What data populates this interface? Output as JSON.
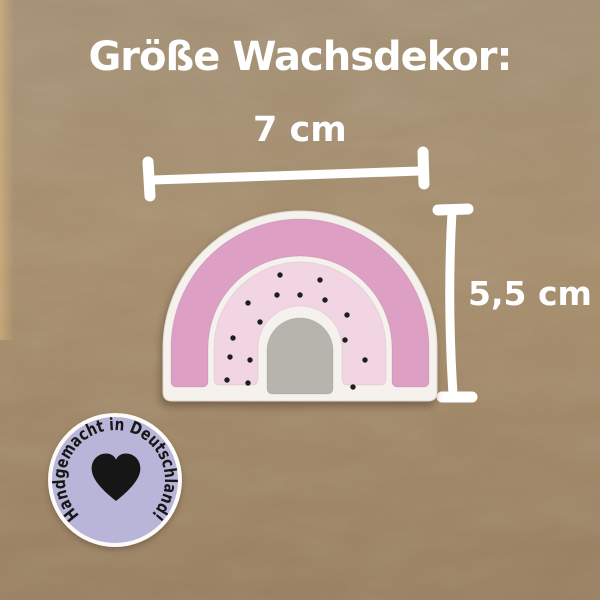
{
  "page": {
    "title": "Größe Wachsdekor:"
  },
  "measurements": {
    "width_label": "7 cm",
    "height_label": "5,5 cm"
  },
  "product": {
    "description": "rainbow wax decoration",
    "colors": {
      "base": "#f5f2ee",
      "outer_band": "#dd9fc3",
      "dotted_band": "#f2d5e3",
      "dome": "#b7b4ae",
      "dots": "#1f1f1f"
    },
    "dots": [
      [
        280,
        275
      ],
      [
        320,
        280
      ],
      [
        277,
        295
      ],
      [
        300,
        295
      ],
      [
        325,
        300
      ],
      [
        248,
        303
      ],
      [
        347,
        315
      ],
      [
        260,
        322
      ],
      [
        233,
        338
      ],
      [
        345,
        340
      ],
      [
        230,
        357
      ],
      [
        250,
        360
      ],
      [
        365,
        360
      ],
      [
        227,
        380
      ],
      [
        248,
        383
      ],
      [
        353,
        387
      ]
    ]
  },
  "badge": {
    "text": "Handgemacht in Deutschland!",
    "background_color": "#b8b5d8",
    "ring_color": "#fdfbf7",
    "heart_color": "#161616",
    "text_color": "#171717"
  },
  "canvas": {
    "background_color": "#a28a69",
    "annotation_color": "#ffffff"
  }
}
